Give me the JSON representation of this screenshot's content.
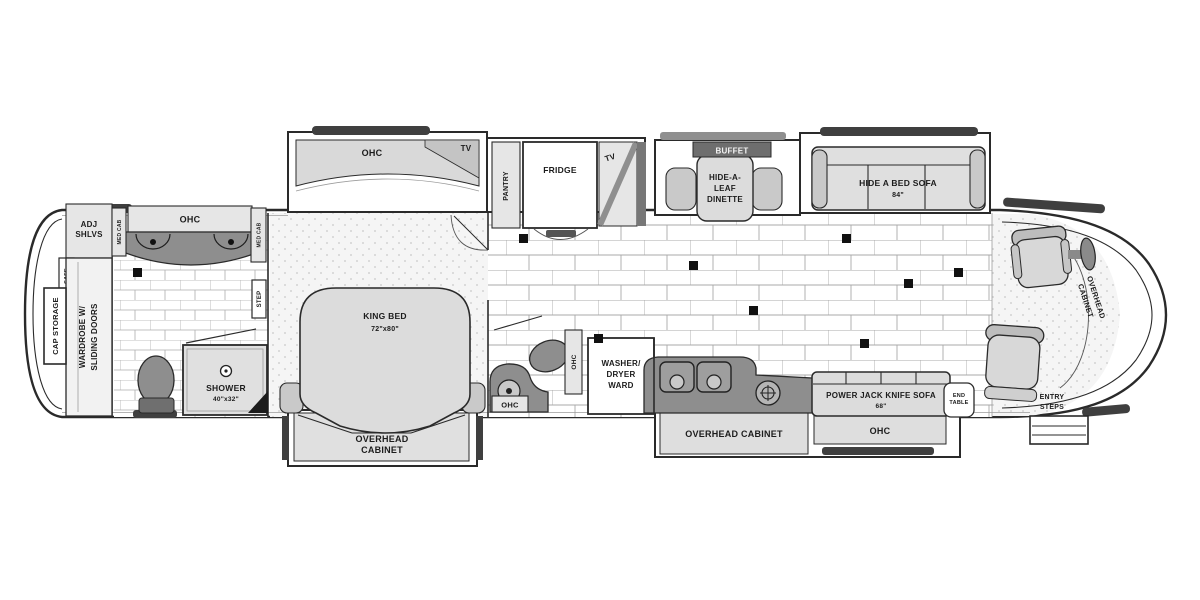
{
  "palette": {
    "ink": "#2a2a2a",
    "counter": "#8e8e8e",
    "furn": "#dcdcdc",
    "light": "#e6e6e6",
    "bumper": "#3f3f3f",
    "bg": "#ffffff"
  },
  "labels": {
    "ohc": "OHC",
    "tv": "TV",
    "pantry": "PANTRY",
    "fridge": "FRIDGE",
    "buffet": "BUFFET",
    "dinette": [
      "HIDE-A-",
      "LEAF",
      "DINETTE"
    ],
    "hide_a_bed_sofa": "HIDE A BED SOFA",
    "hide_a_bed_size": "84\"",
    "adj_shlvs": [
      "ADJ",
      "SHLVS"
    ],
    "safe": "SAFE",
    "wardrobe": [
      "WARDROBE W/",
      "SLIDING DOORS"
    ],
    "cap_storage": "CAP STORAGE",
    "med_cab": "MED CAB",
    "step": "STEP",
    "shower": "SHOWER",
    "shower_size": "40\"x32\"",
    "king_bed": "KING BED",
    "king_bed_size": "72\"x80\"",
    "overhead_cabinet": [
      "OVERHEAD",
      "CABINET"
    ],
    "overhead_cabinet_inline": "OVERHEAD CABINET",
    "washer": [
      "WASHER/",
      "DRYER",
      "WARD"
    ],
    "power_sofa": "POWER JACK KNIFE SOFA",
    "power_sofa_size": "68\"",
    "end_table": [
      "END",
      "TABLE"
    ],
    "entry_steps": [
      "ENTRY",
      "STEPS"
    ]
  }
}
